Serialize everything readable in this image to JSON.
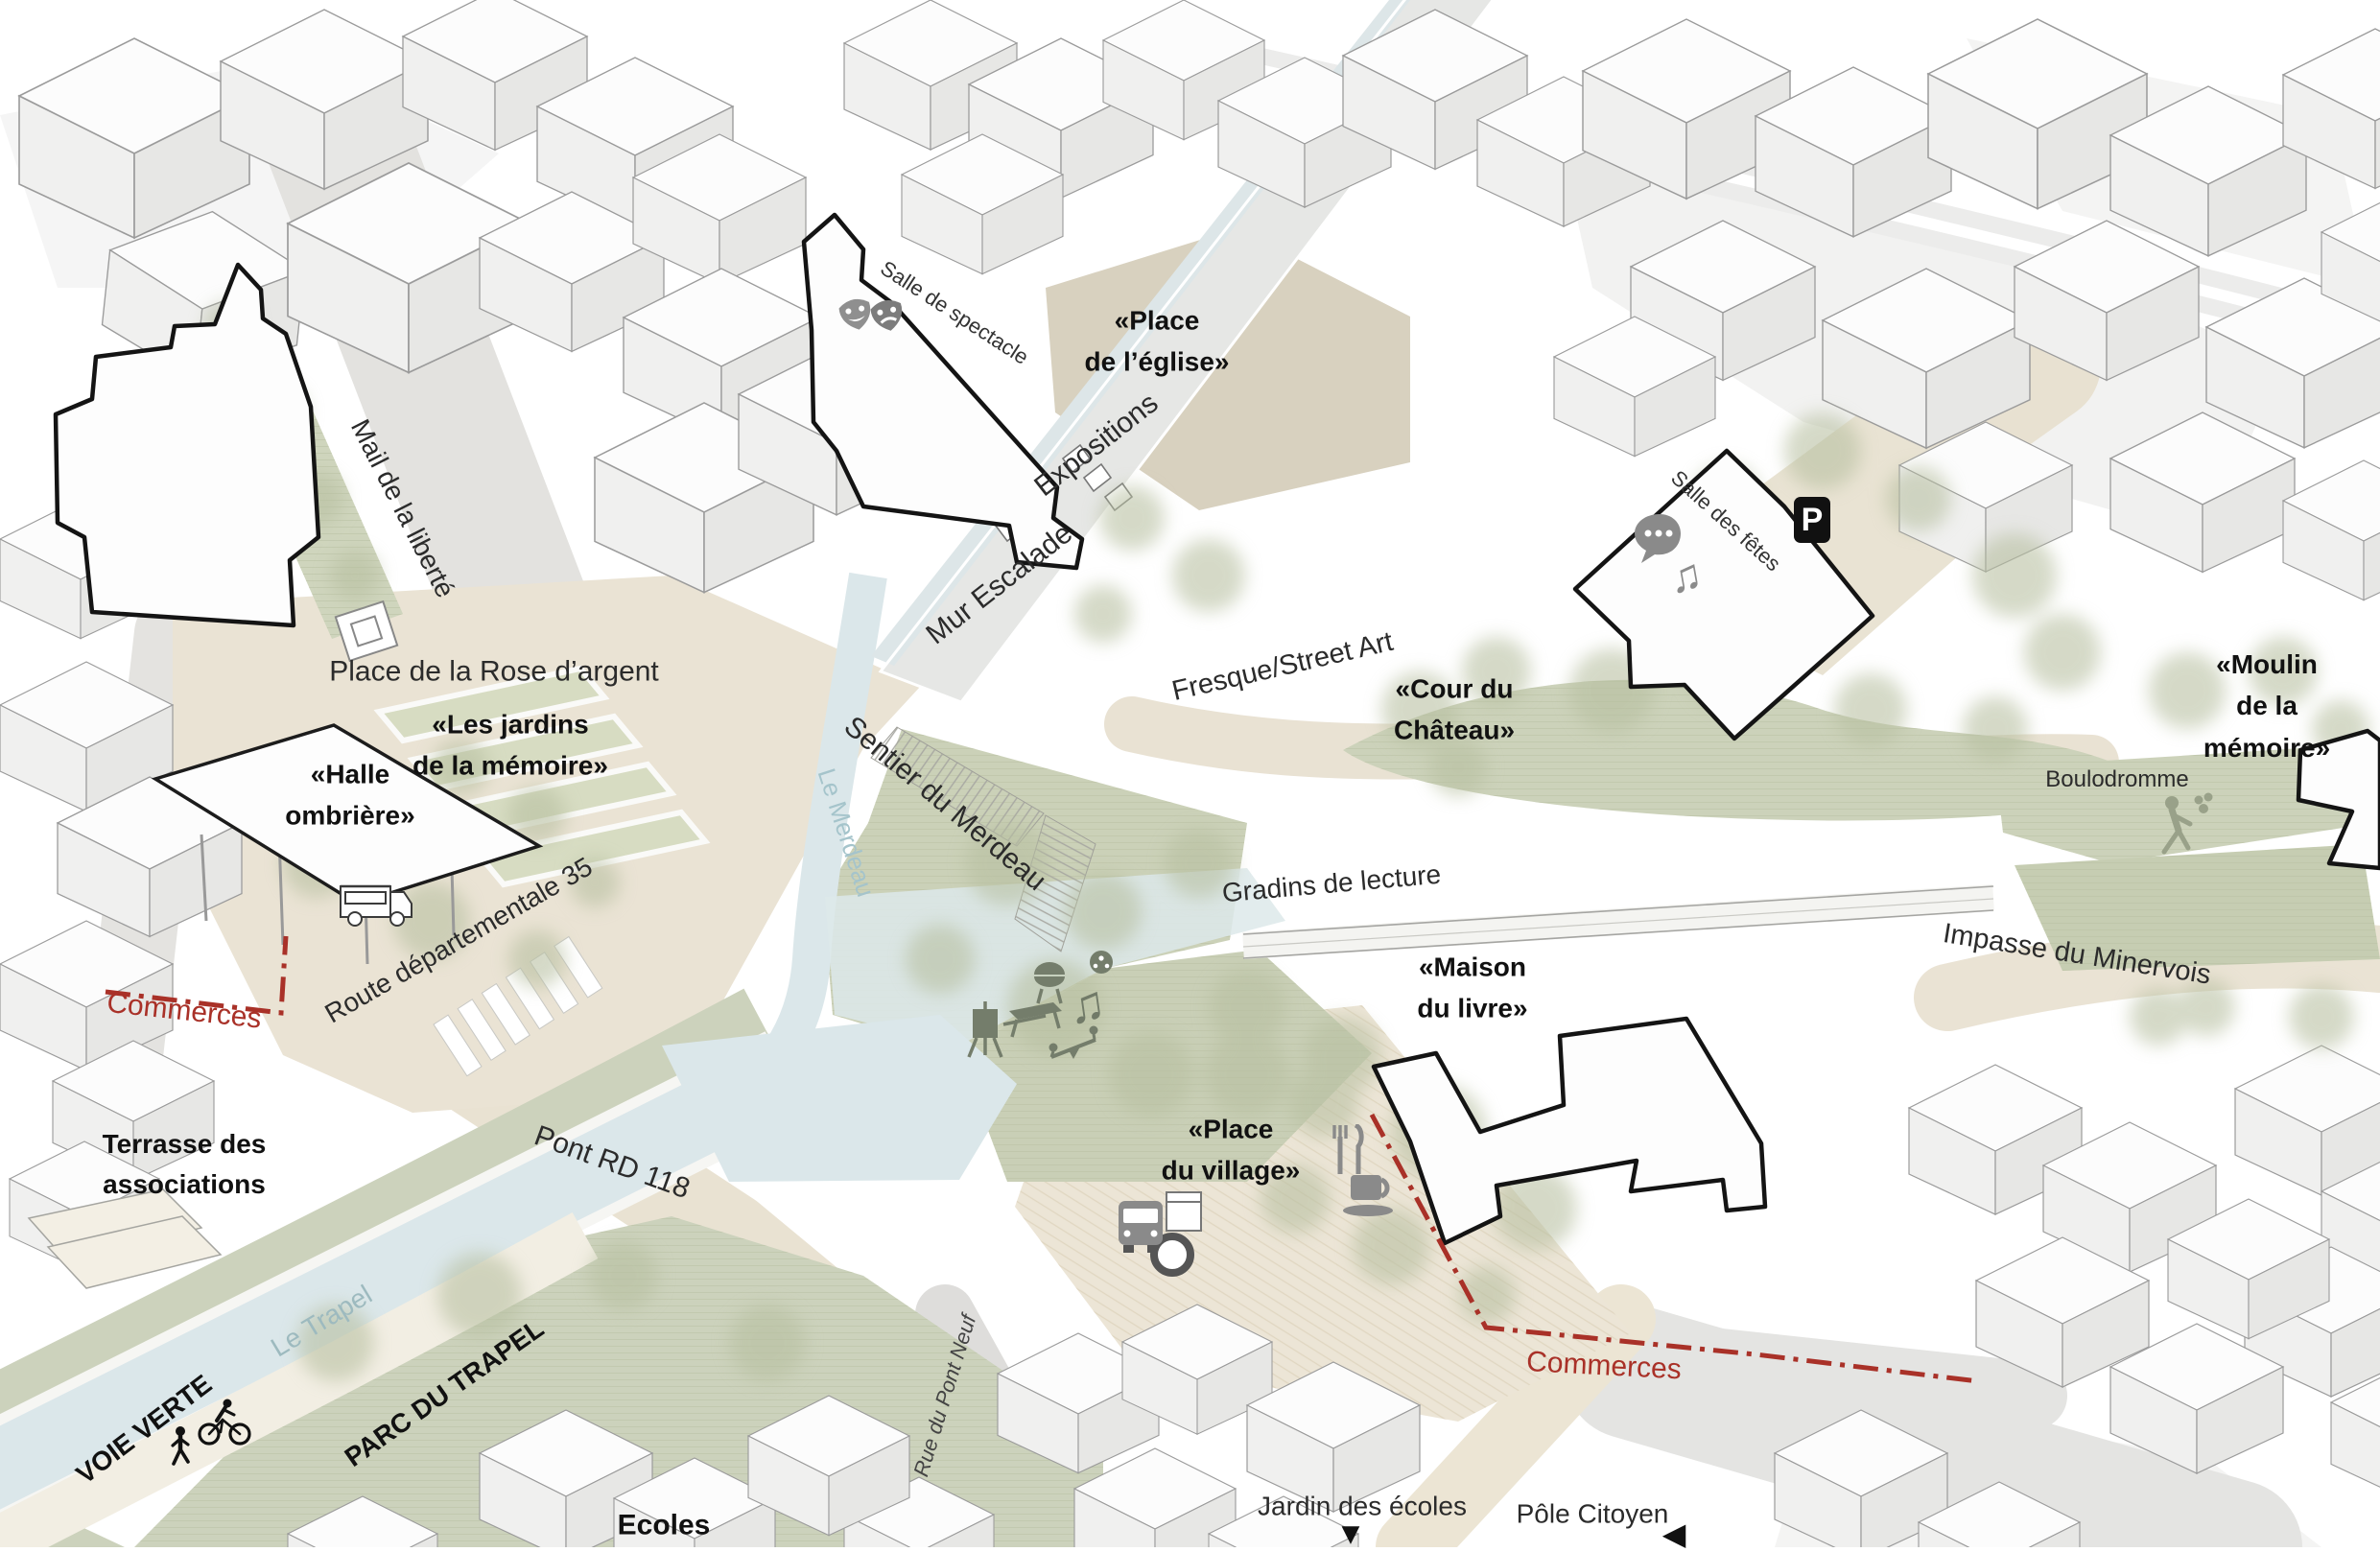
{
  "labels": {
    "salle_de_spectacle": "Salle de spectacle",
    "place_eglise": "«Place\nde l’église»",
    "expositions": "Expositions",
    "mur_escalade": "Mur Escalade",
    "mail_liberte": "Mail de la liberté",
    "place_rose_argent": "Place de la Rose d’argent",
    "fresque_street_art": "Fresque/Street Art",
    "cour_chateau": "«Cour du\nChâteau»",
    "salle_des_fetes": "Salle des fêtes",
    "moulin_memoire": "«Moulin de la\nmémoire»",
    "boulodromme": "Boulodromme",
    "jardins_memoire": "«Les jardins\nde la mémoire»",
    "halle_ombriere": "«Halle\nombrière»",
    "commerces_ouest": "Commerces",
    "route_departementale": "Route départementale 35",
    "sentier_merdeau": "Sentier du Merdeau",
    "le_merdeau": "Le Merdeau",
    "gradins_lecture": "Gradins de lecture",
    "maison_livre": "«Maison\ndu livre»",
    "impasse_minervois": "Impasse du Minervois",
    "terrasse_associations": "Terrasse des\nassociations",
    "pont_rd118": "Pont RD 118",
    "place_village": "«Place\ndu village»",
    "commerces_est": "Commerces",
    "le_trapel": "Le Trapel",
    "voie_verte": "VOIE VERTE",
    "parc_trapel": "PARC DU TRAPEL",
    "ecoles": "Ecoles",
    "rue_pont_neuf": "Rue du Pont Neuf",
    "jardin_ecoles": "Jardin des écoles",
    "pole_citoyen": "Pôle Citoyen"
  },
  "icons": {
    "parking": "P",
    "triangle_down": "▼",
    "triangle_left": "◀",
    "music_note": "♫"
  },
  "colors": {
    "commerce_red": "#a93128",
    "park_green": "#ccd2ba",
    "plaza_beige": "#eae3d4",
    "church_plaza_tan": "#d8d1bf",
    "water_blue": "#dbe7ea",
    "highlight_outline": "#141414",
    "river_label_blue": "#9dbabf"
  }
}
